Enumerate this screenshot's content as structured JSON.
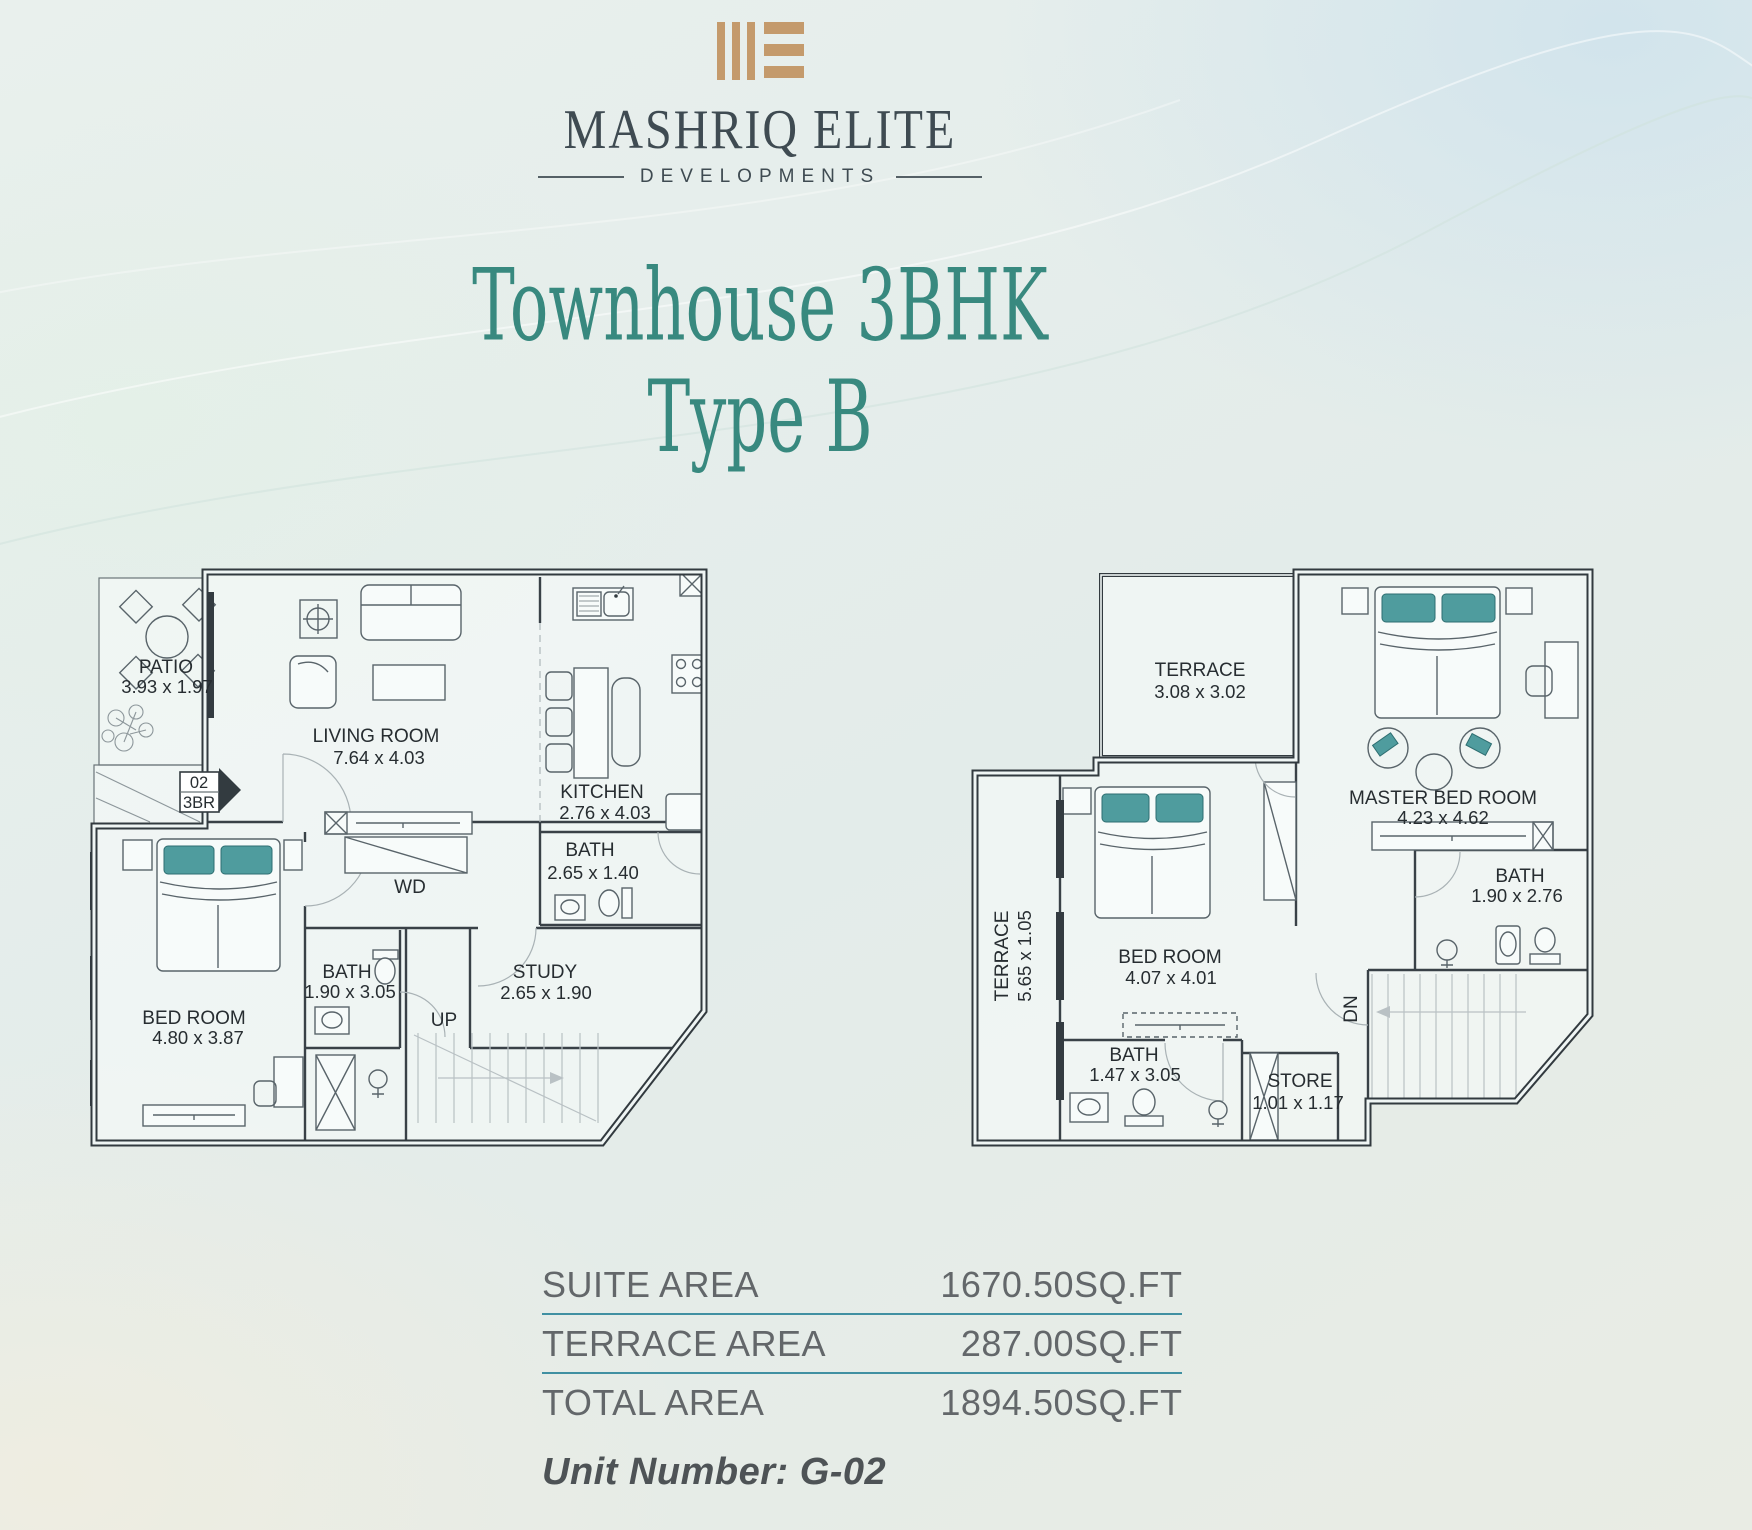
{
  "brand": {
    "name": "MASHRIQ ELITE",
    "tagline": "DEVELOPMENTS"
  },
  "title": {
    "line1": "Townhouse 3BHK",
    "line2": "Type B"
  },
  "colors": {
    "logo_gold": "#c49a6c",
    "brand_ink": "#3f4b52",
    "title_teal": "#38897f",
    "table_rule_teal": "#4090a2",
    "plan_ink": "#323a3f",
    "pillow_teal": "#4f9c9e",
    "table_text": "#63676a"
  },
  "floor_ground": {
    "rooms": {
      "patio": {
        "name": "PATIO",
        "dims": "3.93 x 1.97"
      },
      "living": {
        "name": "LIVING ROOM",
        "dims": "7.64 x 4.03"
      },
      "kitchen": {
        "name": "KITCHEN",
        "dims": "2.76 x 4.03"
      },
      "bath_top": {
        "name": "BATH",
        "dims": "2.65 x 1.40"
      },
      "wd": {
        "name": "WD"
      },
      "bath_left": {
        "name": "BATH",
        "dims": "1.90 x 3.05"
      },
      "study": {
        "name": "STUDY",
        "dims": "2.65 x 1.90"
      },
      "bedroom": {
        "name": "BED ROOM",
        "dims": "4.80 x 3.87"
      },
      "stairs": {
        "name": "UP"
      },
      "unit_marker": {
        "line1": "02",
        "line2": "3BR"
      }
    }
  },
  "floor_first": {
    "rooms": {
      "terrace_top": {
        "name": "TERRACE",
        "dims": "3.08 x 3.02"
      },
      "master": {
        "name": "MASTER BED ROOM",
        "dims": "4.23 x 4.62"
      },
      "terrace_side": {
        "name": "TERRACE",
        "dims": "5.65 x 1.05"
      },
      "bedroom": {
        "name": "BED ROOM",
        "dims": "4.07 x 4.01"
      },
      "bath_right": {
        "name": "BATH",
        "dims": "1.90 x 2.76"
      },
      "bath_bottom": {
        "name": "BATH",
        "dims": "1.47 x 3.05"
      },
      "store": {
        "name": "STORE",
        "dims": "1.01 x 1.17"
      },
      "stairs": {
        "name": "DN"
      }
    }
  },
  "areas": {
    "rows": [
      {
        "label": "SUITE AREA",
        "value": "1670.50",
        "unit": "SQ.FT"
      },
      {
        "label": "TERRACE AREA",
        "value": "287.00",
        "unit": "SQ.FT"
      },
      {
        "label": "TOTAL AREA",
        "value": "1894.50",
        "unit": "SQ.FT"
      }
    ],
    "unit_number": "Unit Number: G-02"
  }
}
